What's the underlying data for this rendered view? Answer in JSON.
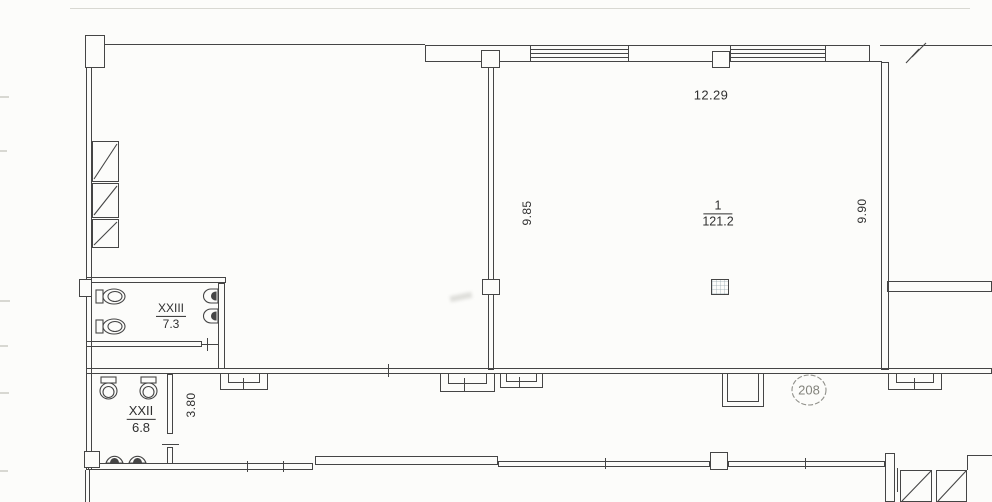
{
  "document": {
    "kind": "scanned architectural floor plan"
  },
  "colors": {
    "ink": "#454545",
    "paper": "#fcfcfa",
    "faint": "#90908a"
  },
  "dims": {
    "top": "12.29",
    "mid_vertical": "9.85",
    "right_vertical": "9.90",
    "corridor_vertical": "3.80"
  },
  "rooms": {
    "main": {
      "number": "1",
      "area": "121.2"
    },
    "wc_upper": {
      "number": "XXIII",
      "area": "7.3"
    },
    "wc_lower": {
      "number": "XXII",
      "area": "6.8"
    }
  },
  "refs": {
    "door_circle": "208"
  }
}
